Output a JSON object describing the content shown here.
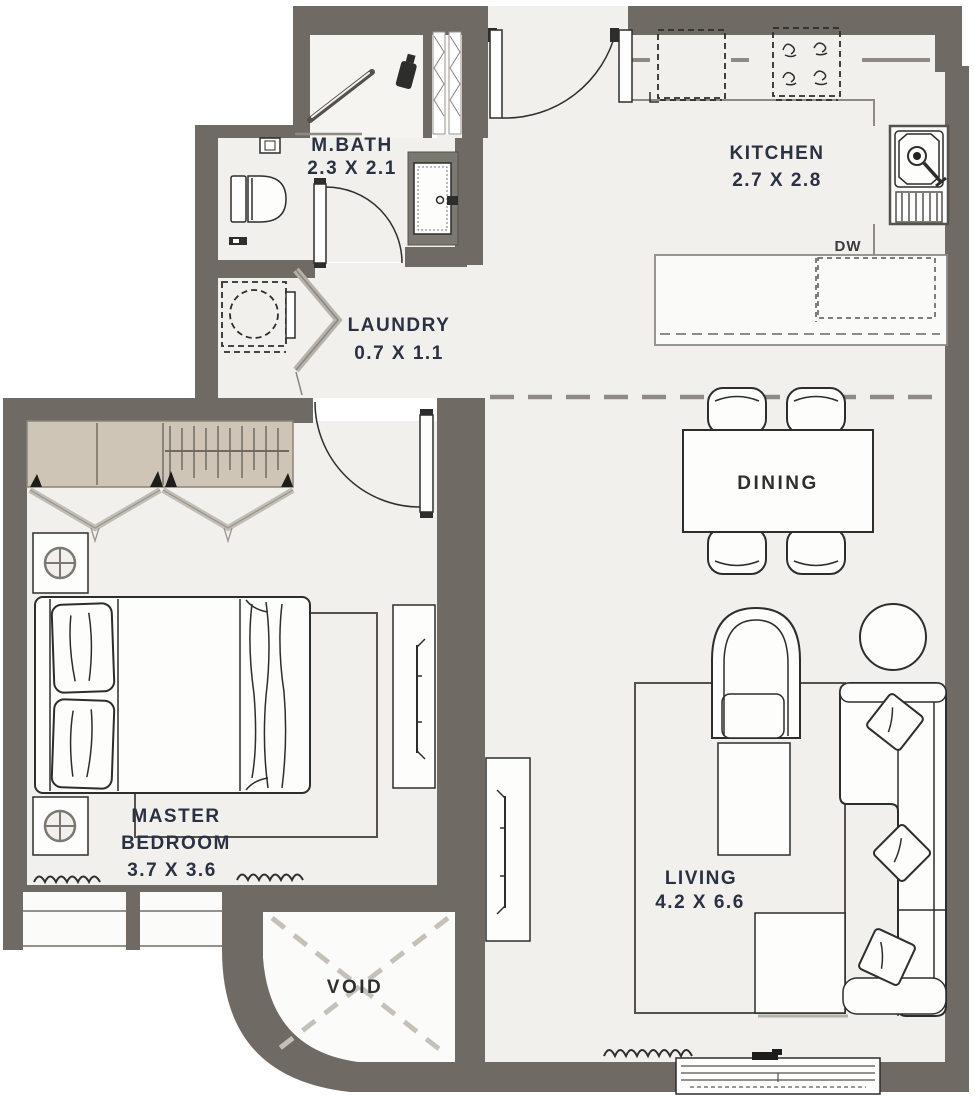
{
  "floor_plan": {
    "title": "apartment-floor-plan",
    "rooms": [
      {
        "id": "mbath",
        "name": "M.BATH",
        "dims": "2.3 X 2.1"
      },
      {
        "id": "laundry",
        "name": "LAUNDRY",
        "dims": "0.7 X 1.1"
      },
      {
        "id": "kitchen",
        "name": "KITCHEN",
        "dims": "2.7 X 2.8"
      },
      {
        "id": "dining",
        "name": "DINING",
        "dims": ""
      },
      {
        "id": "master_bedroom",
        "name_line1": "MASTER",
        "name_line2": "BEDROOM",
        "dims": "3.7 X 3.6"
      },
      {
        "id": "living",
        "name": "LIVING",
        "dims": "4.2 X 6.6"
      },
      {
        "id": "void",
        "name": "VOID",
        "dims": ""
      }
    ],
    "appliance_labels": {
      "dishwasher": "DW"
    },
    "colors": {
      "wall": "#6f6b64",
      "floor": "#f1f0ec",
      "closet": "#cec5b7",
      "line": "#2d2d2b",
      "label": "#2a3142",
      "dash_gray": "#8f8b84"
    }
  }
}
